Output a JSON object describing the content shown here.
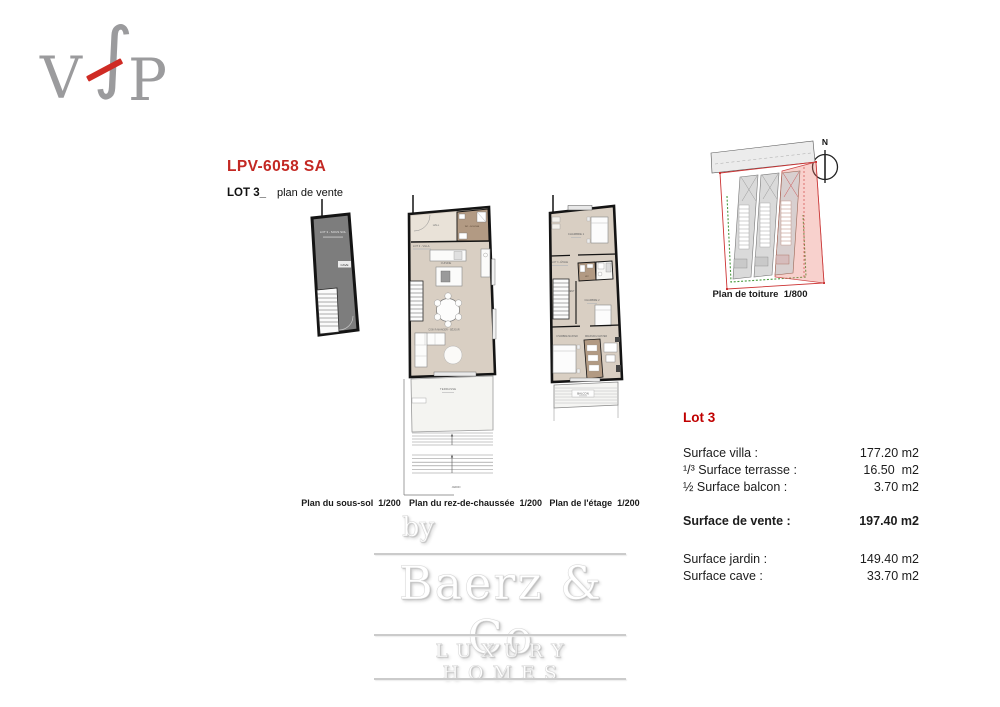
{
  "header": {
    "reference": "LPV-6058 SA",
    "lot_heading": "LOT 3_",
    "lot_subheading": "plan de vente"
  },
  "logo_vfp": {
    "v": "V",
    "f": "∫",
    "p": "P"
  },
  "plans": {
    "sous_sol": {
      "caption": "Plan du sous-sol  1/200",
      "label_lot": "LOT 3 - SOUS SOL",
      "label_cave": "CAVE"
    },
    "rdc": {
      "caption": "Plan du rez-de-chaussée  1/200",
      "label_lot": "LOT 3 - VILLA",
      "label_hall": "HALL",
      "label_wc": "WC - DOUCHE",
      "label_cuisine": "CUISINE",
      "label_sejour": "COIN À MANGER - SÉJOUR",
      "label_terrasse": "TERRASSE",
      "label_jardin": "JARDIN"
    },
    "etage": {
      "caption": "Plan de l'étage  1/200",
      "label_lot": "LOT 3 - ÉTAGE",
      "label_chambre1": "CHAMBRE 1",
      "label_wc": "WC",
      "label_degagement": "DÉGAGEMENT",
      "label_chambre2": "CHAMBRE 2",
      "label_master": "CHAMBRE MASTER",
      "label_dressing": "DRESSING MASTER",
      "label_balcon": "BALCON"
    },
    "toiture": {
      "caption": "Plan de toiture  1/800",
      "north_label": "N"
    }
  },
  "surfaces": {
    "title": "Lot 3",
    "rows": [
      {
        "label": "Surface villa :",
        "value": "177.20 m2"
      },
      {
        "label": "¹/³ Surface terrasse :",
        "value": "16.50  m2"
      },
      {
        "label": "½ Surface balcon :",
        "value": "3.70 m2"
      },
      {
        "label": "Surface de vente :",
        "value": "197.40 m2"
      },
      {
        "label": "Surface jardin :",
        "value": "149.40 m2"
      },
      {
        "label": "Surface cave :",
        "value": "33.70 m2"
      }
    ]
  },
  "watermark": {
    "by": "by",
    "name": "Baerz & Co",
    "tagline": "LUXURY HOMES"
  },
  "colors": {
    "accent_red": "#c32823",
    "lot_title_red": "#c00000",
    "logo_gray": "#9b9b9d",
    "logo_slash_red": "#cf2b24",
    "floor_beige": "#d9cfc3",
    "room_brown": "#b29a83",
    "basement_gray": "#7d7d7d",
    "site_boundary_red": "#cc3333",
    "site_boundary_green": "#4a9a40"
  }
}
